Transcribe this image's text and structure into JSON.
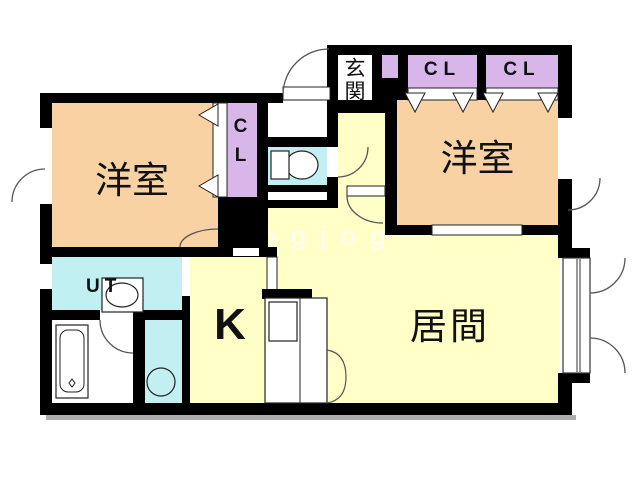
{
  "plan": {
    "title": "1LDK apartment floor plan",
    "watermark": "jogjog",
    "rooms": {
      "bedroom_left": {
        "label": "洋室",
        "color": "#f8d2a2"
      },
      "bedroom_right": {
        "label": "洋室",
        "color": "#f8d2a2"
      },
      "living": {
        "label": "居間",
        "color": "#ffffc8"
      },
      "kitchen": {
        "label": "K",
        "color": "#ffffc8"
      },
      "utility": {
        "label": "UT",
        "color": "#c2f0f2"
      },
      "toilet": {
        "color": "#c2f0f2"
      },
      "entrance": {
        "label": "玄関",
        "color": "#ffffff"
      },
      "closet_left": {
        "label": "CL",
        "color": "#d9b6ea"
      },
      "closet_top_1": {
        "label": "CL",
        "color": "#d9b6ea"
      },
      "closet_top_2": {
        "label": "CL",
        "color": "#d9b6ea"
      }
    },
    "colors": {
      "wall": "#000000",
      "outline": "#333333",
      "arc": "#555555",
      "shadow": "#aeaeae"
    }
  }
}
